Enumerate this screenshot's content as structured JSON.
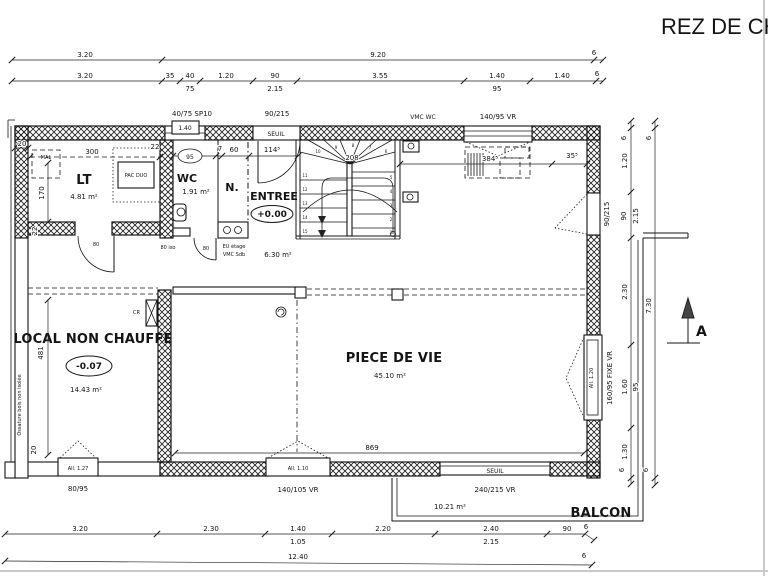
{
  "title": "REZ DE CH",
  "rooms": {
    "lt": {
      "name": "LT",
      "area": "4.81 m²"
    },
    "wc": {
      "name": "WC",
      "area": "1.91 m²"
    },
    "n": {
      "name": "N."
    },
    "entree": {
      "name": "ENTREE",
      "level": "+0.00",
      "area": "6.30 m²"
    },
    "local": {
      "name": "LOCAL NON CHAUFFE",
      "level": "-0.07",
      "area": "14.43 m²"
    },
    "piece": {
      "name": "PIECE DE VIE",
      "area": "45.10 m²"
    },
    "balcon": {
      "name": "BALCON",
      "area": "10.21 m²"
    }
  },
  "equipment": {
    "pac": "PAC DUO",
    "mal": "MAL",
    "cr": "CR",
    "eu1": "EU étage",
    "eu2": "VMC Sdb",
    "vmc_wc": "VMC WC",
    "ossature": "Ossature bois non isolée"
  },
  "openings": {
    "sp10": "40/75 SP10",
    "sp10_allege": "1.40",
    "top_door": "90/215",
    "top_seuil": "SEUIL",
    "top_win": "140/95 VR",
    "right_door": "90/215",
    "right_win": "160/95 FIXE VR",
    "right_win_allege": "All. 1.20",
    "bay": "240/215 VR",
    "bay_seuil": "SEUIL",
    "bottom_win": "140/105 VR",
    "bottom_win_allege": "All. 1.10",
    "local_win": "80/95",
    "local_win_allege": "All. 1.27",
    "door_lt": "80",
    "door_iso": "80 iso",
    "door_wc": "80"
  },
  "dims": {
    "top1": [
      "3.20",
      "9.20",
      "6"
    ],
    "top2": [
      "3.20",
      "35",
      "40",
      "75",
      "1.20",
      "90",
      "2.15",
      "3.55",
      "1.40",
      "95",
      "1.40",
      "6"
    ],
    "bottom1": [
      "3.20",
      "2.30",
      "1.40",
      "1.05",
      "2.20",
      "2.40",
      "2.15",
      "90",
      "6"
    ],
    "bottom2": [
      "12.40",
      "6"
    ],
    "right_inner": [
      "6",
      "1.20",
      "90",
      "2.15",
      "2.30",
      "1.60",
      "95",
      "1.30",
      "6"
    ],
    "right_outer": [
      "6",
      "7.30",
      "6"
    ],
    "lt": {
      "w20": "20",
      "w300": "300",
      "h170": "170",
      "t22a": "22",
      "t22b": "22"
    },
    "wc": {
      "w95": "95",
      "w7": "7",
      "w60": "60",
      "w114": "114⁵"
    },
    "local": {
      "h481": "481",
      "h20": "20"
    },
    "piece": {
      "w869": "869"
    },
    "kitchen": {
      "w384": "384⁵",
      "w35": "35⁵"
    }
  },
  "stairs": {
    "going": "208",
    "steps": [
      "1",
      "2",
      "3",
      "4",
      "5",
      "6",
      "7",
      "8",
      "9",
      "10",
      "11",
      "12",
      "13",
      "14",
      "15"
    ]
  },
  "section": {
    "label": "A"
  }
}
